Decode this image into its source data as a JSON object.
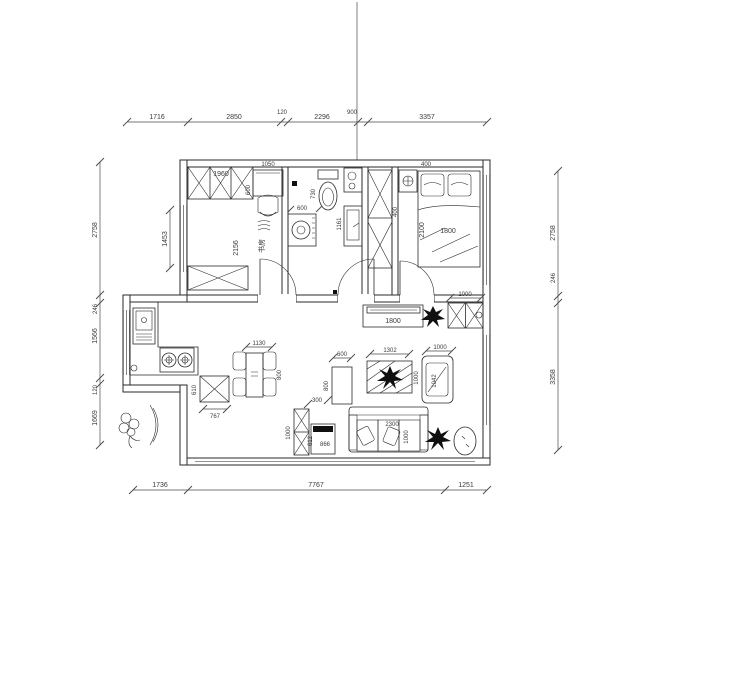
{
  "drawing": {
    "type": "floor-plan",
    "line_color": "#2a2a2a",
    "background": "#ffffff"
  },
  "dimensions": {
    "top": [
      "1716",
      "2850",
      "120",
      "2296",
      "900",
      "3357"
    ],
    "bottom": [
      "1736",
      "7767",
      "1251"
    ],
    "left": [
      "2758",
      "246",
      "1566",
      "120",
      "1669"
    ],
    "right": [
      "2758",
      "246",
      "3358"
    ]
  },
  "labels": {
    "study_room": "书房",
    "study_wardrobe_width": "1960",
    "study_wardrobe_depth": "600",
    "study_desk_width": "1050",
    "study_interior_width": "2156",
    "study_window": "1453",
    "toilet_width": "730",
    "washer_width": "600",
    "vanity_length": "1161",
    "closet_depth": "400",
    "nightstand_width": "400",
    "bed_length": "2100",
    "bed_width": "1800",
    "entry_cabinet_width": "1000",
    "tv_cabinet_width": "1800",
    "coffee_table_width": "1302",
    "coffee_table_depth": "1000",
    "armchair_width": "1000",
    "armchair_depth": "1042",
    "sofa_width": "2300",
    "sofa_depth": "1000",
    "side_cabinet_width": "600",
    "side_cabinet_depth": "800",
    "side_gap": "300",
    "hall_cabinet_height": "1000",
    "small_table_width": "866",
    "small_table_depth": "612",
    "dining_table_width": "1130",
    "dining_table_depth": "800",
    "kitchen_cabinet_width": "767",
    "kitchen_cabinet_depth": "610"
  }
}
